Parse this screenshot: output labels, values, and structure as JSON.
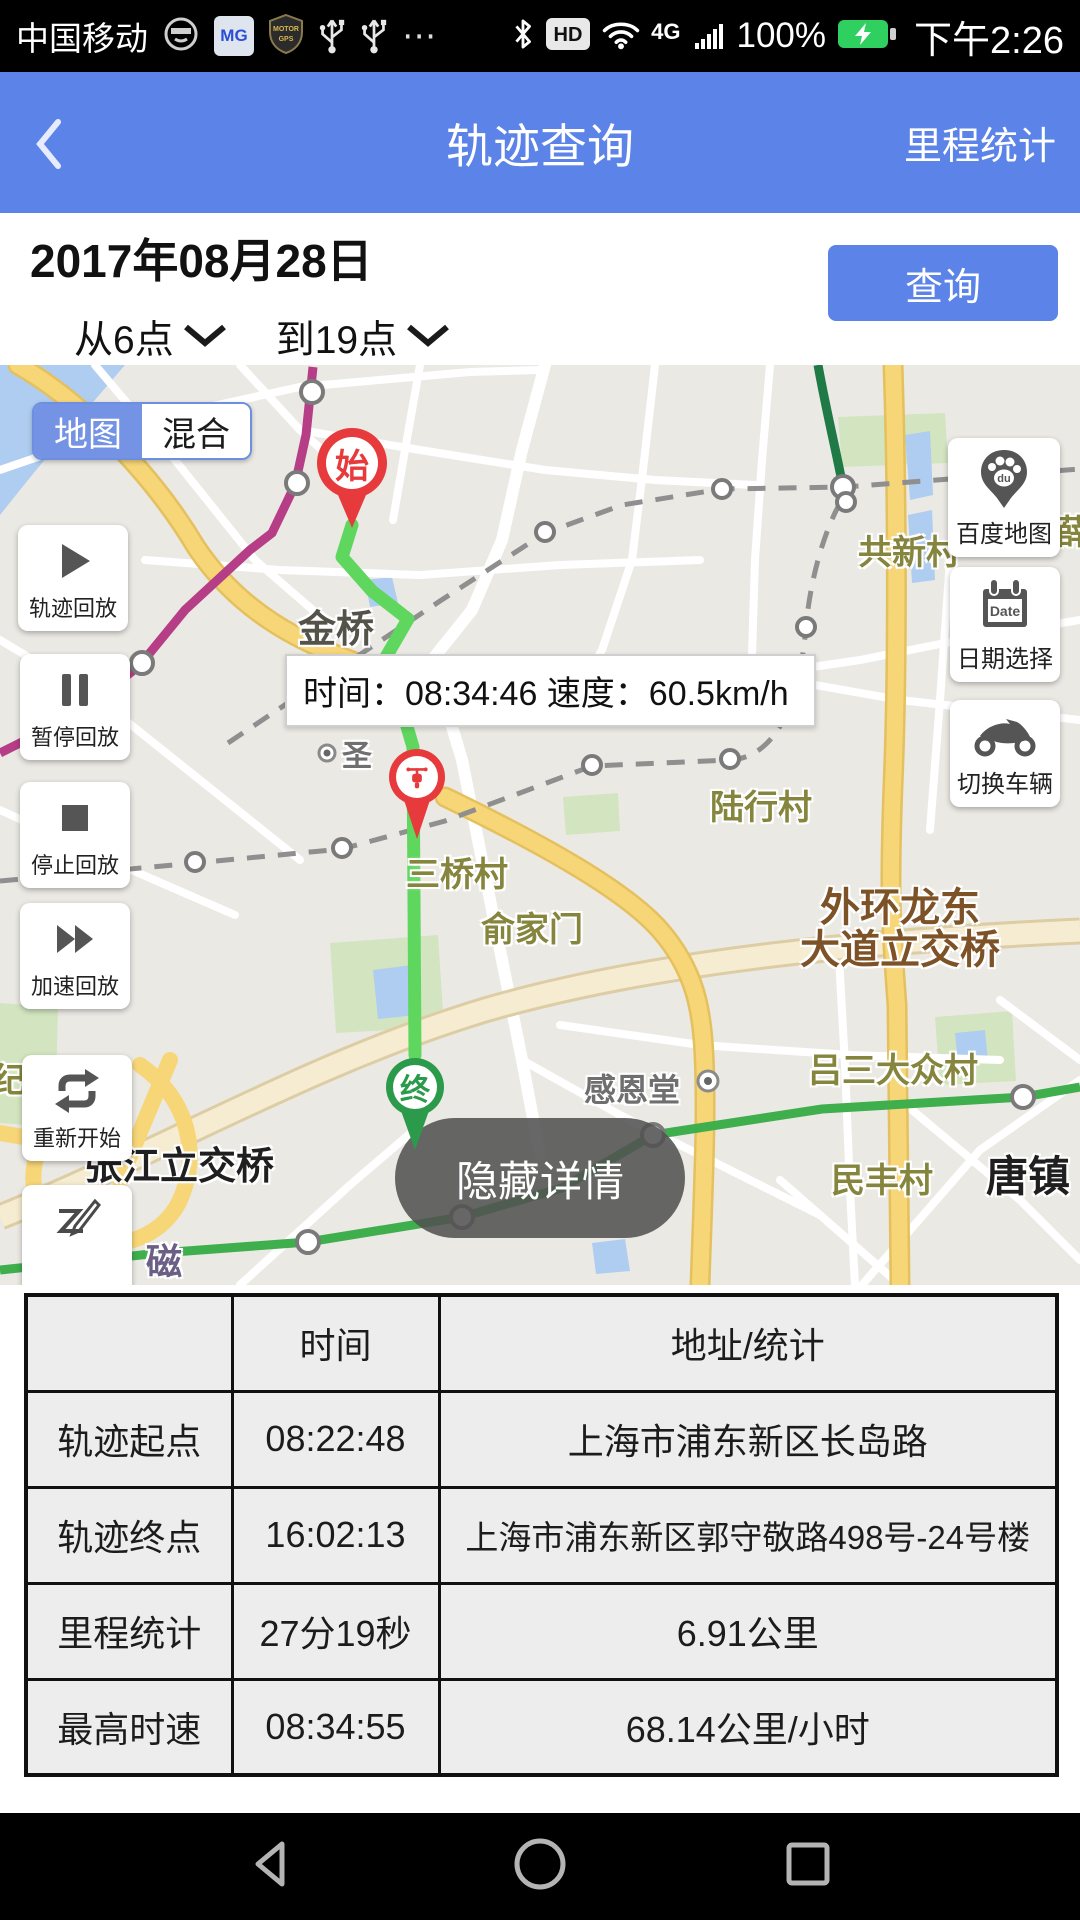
{
  "colors": {
    "accent": "#5b83e8",
    "pin_red": "#e73a3c",
    "pin_green": "#2c9a4b",
    "route_green": "#5fd75f"
  },
  "status_bar": {
    "carrier": "中国移动",
    "mg": "MG",
    "shield_line1": "MOTOR",
    "shield_line2": "GPS",
    "more": "⋯",
    "hd": "HD",
    "network": "4G",
    "battery": "100%",
    "time": "下午2:26"
  },
  "header": {
    "title": "轨迹查询",
    "mileage": "里程统计"
  },
  "query": {
    "date": "2017年08月28日",
    "from": "从6点",
    "to": "到19点",
    "search": "查询"
  },
  "map": {
    "toggle": {
      "map": "地图",
      "hybrid": "混合"
    },
    "bubble": "时间：08:34:46 速度：60.5km/h",
    "hide_details": "隐藏详情",
    "start": "始",
    "end": "终",
    "left_controls": [
      {
        "label": "轨迹回放"
      },
      {
        "label": "暂停回放"
      },
      {
        "label": "停止回放"
      },
      {
        "label": "加速回放"
      },
      {
        "label": "重新开始"
      },
      {
        "label": ""
      }
    ],
    "right_controls": [
      {
        "label": "百度地图",
        "badge": "du"
      },
      {
        "label": "日期选择",
        "badge": "Date"
      },
      {
        "label": "切换车辆"
      }
    ],
    "labels": {
      "jinqiao": "金桥",
      "gongxin": "共新村",
      "xue": "薛",
      "luxing": "陆行村",
      "sanqiao": "三桥村",
      "yujiamen": "俞家门",
      "waihuan1": "外环龙东",
      "waihuan2": "大道立交桥",
      "ganen": "感恩堂",
      "lvsan": "吕三大众村",
      "minfeng": "民丰村",
      "tangzhen": "唐镇",
      "zhangjiang": "张江立交桥",
      "ji": "纪",
      "ci": "磁",
      "sheng": "圣"
    }
  },
  "table": {
    "headers": [
      "",
      "时间",
      "地址/统计"
    ],
    "rows": [
      [
        "轨迹起点",
        "08:22:48",
        "上海市浦东新区长岛路"
      ],
      [
        "轨迹终点",
        "16:02:13",
        "上海市浦东新区郭守敬路498号-24号楼"
      ],
      [
        "里程统计",
        "27分19秒",
        "6.91公里"
      ],
      [
        "最高时速",
        "08:34:55",
        "68.14公里/小时"
      ]
    ]
  }
}
